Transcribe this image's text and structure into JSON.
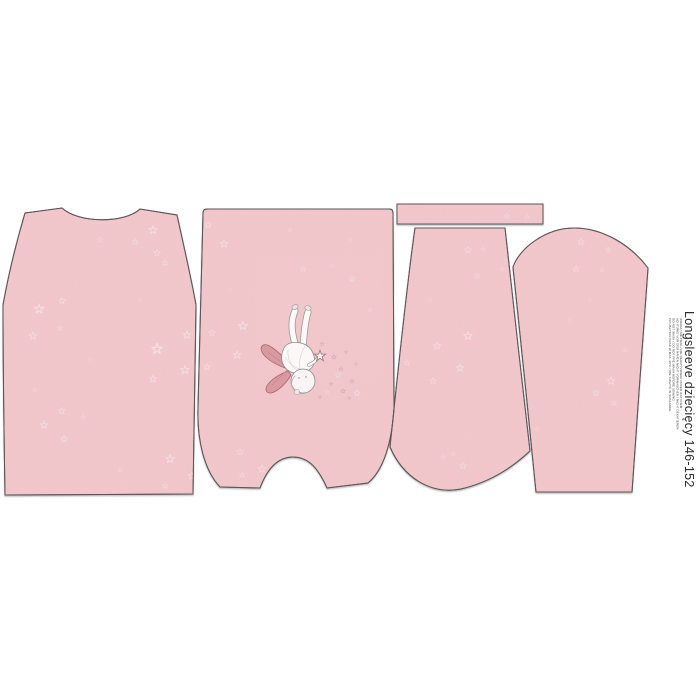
{
  "label": {
    "title": "Longsleeve dziecięcy 146-152",
    "care_lines": [
      "UWAGA! NIE PRAĆ / NIE DEKATYZOWAĆ PRZED USZYCIEM",
      "ACHTUNG! VOR DEM NÄHEN NICHT VORWASCHEN / NICHT DEKATIEREN",
      "DO NOT WASH / DO NOT PRE-WASH BEFORE SEWING",
      "PO USZYCIU PRAĆ W MAX. 30°C / NIE SUSZYĆ W SUSZARCE"
    ]
  },
  "pieces": [
    {
      "name": "back"
    },
    {
      "name": "front-with-fairy-print"
    },
    {
      "name": "neckband"
    },
    {
      "name": "sleeve-left"
    },
    {
      "name": "sleeve-right"
    }
  ],
  "colors": {
    "background": "#ffffff",
    "fabric": "#f1c7cb",
    "speckle": "#d98e96",
    "outline": "#5d5556",
    "star": "#f2e4e5",
    "sparkle": "#c9a2a6",
    "wing": "#d999a0",
    "wing-outline": "#a8666d",
    "text": "#2d2d2d"
  },
  "decor": {
    "stars": [
      [
        39,
        309,
        1,
        0.8
      ],
      [
        62,
        301,
        0.7,
        0.7
      ],
      [
        33,
        336,
        0.8,
        0.75
      ],
      [
        60,
        328,
        0.6,
        0.6
      ],
      [
        100,
        240,
        0.6,
        0.5
      ],
      [
        153,
        230,
        0.9,
        0.8
      ],
      [
        135,
        242,
        0.6,
        0.6
      ],
      [
        157,
        253,
        0.7,
        0.65
      ],
      [
        165,
        263,
        0.6,
        0.6
      ],
      [
        157,
        349,
        1.1,
        0.9
      ],
      [
        187,
        335,
        0.8,
        0.75
      ],
      [
        185,
        370,
        0.9,
        0.8
      ],
      [
        153,
        379,
        0.8,
        0.7
      ],
      [
        62,
        411,
        0.7,
        0.6
      ],
      [
        44,
        425,
        0.8,
        0.7
      ],
      [
        64,
        439,
        0.7,
        0.65
      ],
      [
        83,
        417,
        0.5,
        0.5
      ],
      [
        170,
        459,
        0.9,
        0.75
      ],
      [
        192,
        476,
        0.8,
        0.7
      ],
      [
        165,
        486,
        0.6,
        0.6
      ],
      [
        35,
        390,
        0.5,
        0.45
      ],
      [
        120,
        470,
        0.5,
        0.45
      ],
      [
        140,
        300,
        0.4,
        0.4
      ],
      [
        90,
        360,
        0.4,
        0.35
      ],
      [
        208,
        225,
        0.7,
        0.6
      ],
      [
        224,
        244,
        0.8,
        0.7
      ],
      [
        303,
        269,
        0.6,
        0.55
      ],
      [
        332,
        266,
        0.5,
        0.5
      ],
      [
        352,
        279,
        0.6,
        0.55
      ],
      [
        243,
        326,
        0.9,
        0.75
      ],
      [
        212,
        333,
        0.7,
        0.6
      ],
      [
        237,
        355,
        0.8,
        0.7
      ],
      [
        207,
        367,
        0.7,
        0.6
      ],
      [
        338,
        375,
        0.6,
        0.55
      ],
      [
        357,
        393,
        0.7,
        0.6
      ],
      [
        327,
        392,
        0.5,
        0.5
      ],
      [
        240,
        452,
        0.7,
        0.6
      ],
      [
        262,
        469,
        0.8,
        0.65
      ],
      [
        242,
        475,
        0.6,
        0.55
      ],
      [
        282,
        480,
        0.7,
        0.6
      ],
      [
        230,
        290,
        0.4,
        0.4
      ],
      [
        370,
        310,
        0.5,
        0.45
      ],
      [
        290,
        230,
        0.5,
        0.45
      ],
      [
        350,
        240,
        0.4,
        0.4
      ],
      [
        507,
        216,
        0.6,
        0.55
      ],
      [
        527,
        217,
        0.5,
        0.5
      ],
      [
        468,
        250,
        0.7,
        0.6
      ],
      [
        483,
        249,
        0.5,
        0.5
      ],
      [
        477,
        276,
        0.6,
        0.55
      ],
      [
        502,
        269,
        0.5,
        0.5
      ],
      [
        468,
        336,
        0.9,
        0.75
      ],
      [
        437,
        346,
        0.8,
        0.65
      ],
      [
        460,
        368,
        0.8,
        0.7
      ],
      [
        433,
        381,
        0.7,
        0.6
      ],
      [
        407,
        363,
        0.6,
        0.55
      ],
      [
        463,
        466,
        0.7,
        0.6
      ],
      [
        443,
        457,
        0.5,
        0.5
      ],
      [
        453,
        454,
        0.5,
        0.45
      ],
      [
        430,
        300,
        0.4,
        0.4
      ],
      [
        581,
        242,
        0.7,
        0.6
      ],
      [
        608,
        250,
        0.6,
        0.55
      ],
      [
        576,
        269,
        0.7,
        0.6
      ],
      [
        602,
        270,
        0.5,
        0.5
      ],
      [
        611,
        381,
        0.8,
        0.7
      ],
      [
        596,
        393,
        0.7,
        0.6
      ],
      [
        614,
        403,
        0.6,
        0.55
      ],
      [
        537,
        429,
        0.5,
        0.5
      ],
      [
        590,
        300,
        0.4,
        0.4
      ],
      [
        625,
        350,
        0.5,
        0.45
      ],
      [
        570,
        320,
        0.4,
        0.35
      ]
    ],
    "sparkles": [
      [
        322,
        344,
        0.45
      ],
      [
        334,
        357,
        0.5
      ],
      [
        341,
        369,
        0.45
      ],
      [
        331,
        384,
        0.4
      ],
      [
        343,
        391,
        0.5
      ],
      [
        320,
        397,
        0.4
      ],
      [
        352,
        381,
        0.45
      ],
      [
        349,
        398,
        0.4
      ],
      [
        346,
        352,
        0.35
      ],
      [
        356,
        364,
        0.35
      ]
    ]
  }
}
